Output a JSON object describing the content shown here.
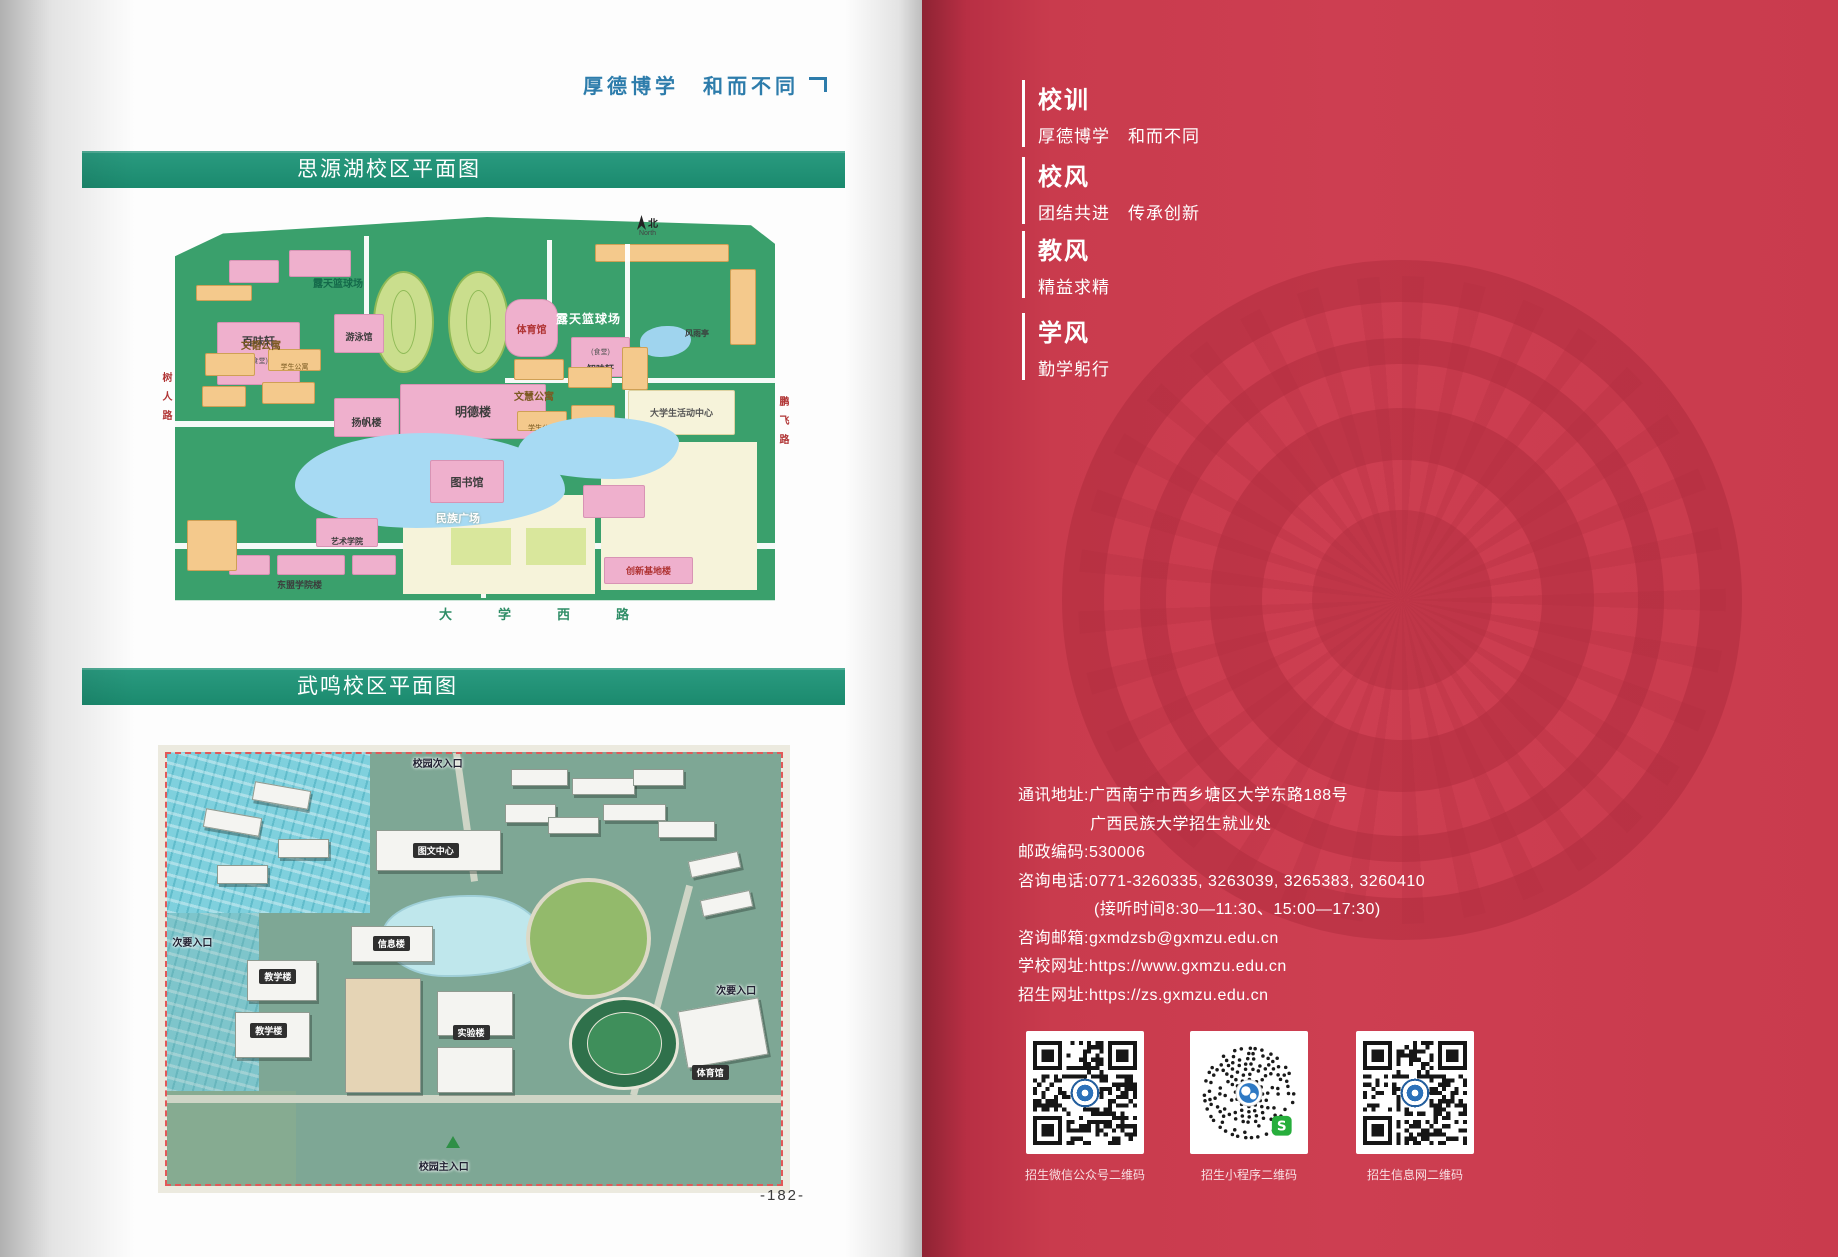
{
  "colors": {
    "banner_green": "#1e8c72",
    "page_red": "#c93b4d",
    "motto_blue": "#2d7cab"
  },
  "left_page": {
    "motto": "厚德博学　和而不同",
    "banner_siyuan": "思源湖校区平面图",
    "banner_wuming": "武鸣校区平面图",
    "page_number": "-182-",
    "map_siyuan": {
      "compass_n": "北",
      "compass_north": "North",
      "road_left": "树人路",
      "road_right": "鹏飞路",
      "road_bottom": "大学西路",
      "labels": {
        "outdoor_court": "露天篮球场",
        "baiweixuan": "百味轩",
        "canteen_suffix": "(食堂)",
        "swimming": "游泳馆",
        "gymnasium": "体育馆",
        "zhiweixuan": "知味轩",
        "pavilion": "风雨亭",
        "wentao_dorm": "文韬公寓",
        "yangfan": "扬帆楼",
        "mingde": "明德楼",
        "wenhui_dorm": "文慧公寓",
        "activity_center": "大学生活动中心",
        "library": "图书馆",
        "minzu_square": "民族广场",
        "art_school": "艺术学院",
        "innovation": "创新基地楼",
        "asean_bldg": "东盟学院楼",
        "dorm": "学生公寓"
      }
    },
    "map_wuming": {
      "labels": {
        "north_entrance": "校园次入口",
        "main_entrance": "校园主入口",
        "side_entrance": "次要入口",
        "tuwen_center": "图文中心",
        "info_bldg": "信息楼",
        "teaching_bldg": "教学楼",
        "lab_bldg": "实验楼",
        "gym": "体育馆"
      }
    }
  },
  "right_page": {
    "sections": [
      {
        "title": "校训",
        "content": "厚德博学　和而不同"
      },
      {
        "title": "校风",
        "content": "团结共进　传承创新"
      },
      {
        "title": "教风",
        "content": "精益求精"
      },
      {
        "title": "学风",
        "content": "勤学躬行"
      }
    ],
    "contact": {
      "lines": [
        "通讯地址:广西南宁市西乡塘区大学东路188号",
        "广西民族大学招生就业处",
        "邮政编码:530006",
        "咨询电话:0771-3260335, 3263039, 3265383, 3260410",
        "(接听时间8:30—11:30、15:00—17:30)",
        "咨询邮箱:gxmdzsb@gxmzu.edu.cn",
        "学校网址:https://www.gxmzu.edu.cn",
        "招生网址:https://zs.gxmzu.edu.cn"
      ]
    },
    "qr_codes": [
      {
        "label": "招生微信公众号二维码",
        "type": "qr"
      },
      {
        "label": "招生小程序二维码",
        "type": "minicode"
      },
      {
        "label": "招生信息网二维码",
        "type": "qr"
      }
    ]
  }
}
